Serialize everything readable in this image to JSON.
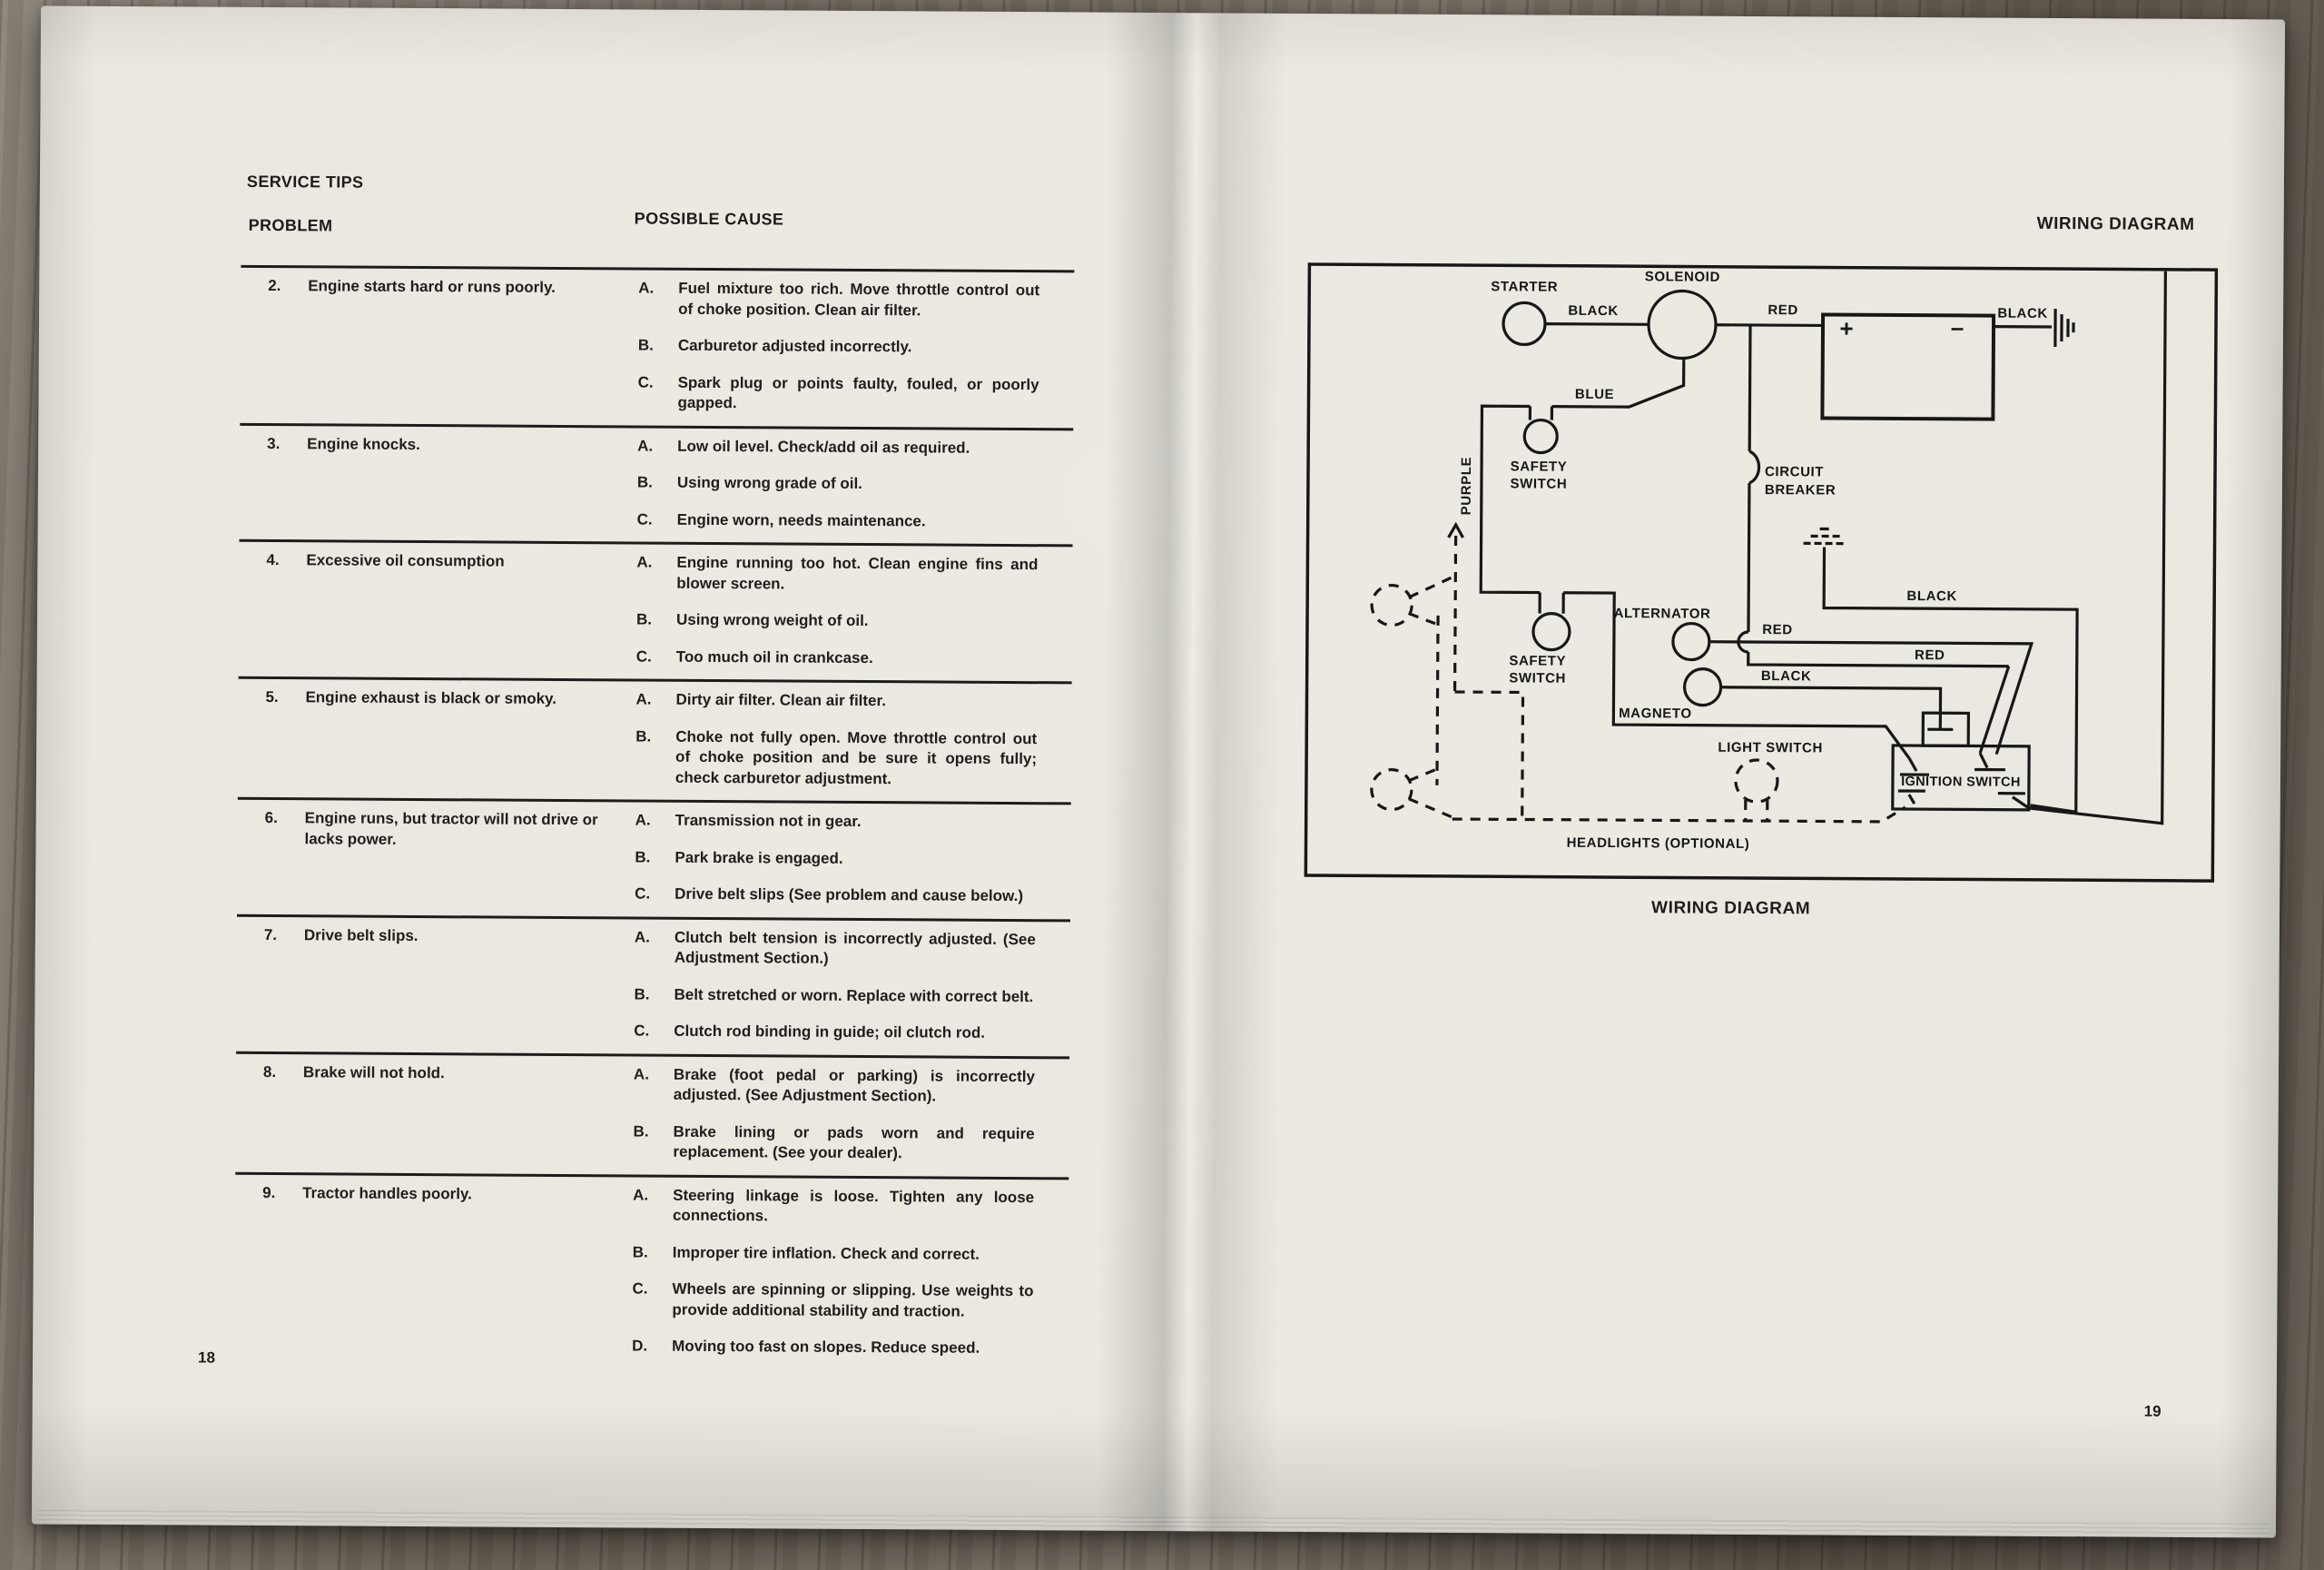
{
  "left_page": {
    "section_title": "SERVICE TIPS",
    "col_problem": "PROBLEM",
    "col_cause": "POSSIBLE CAUSE",
    "page_number": "18",
    "rows": [
      {
        "num": "2.",
        "problem": "Engine starts hard or runs poorly.",
        "causes": [
          {
            "letter": "A.",
            "text": "Fuel mixture too rich. Move throttle control out of choke position.  Clean air filter."
          },
          {
            "letter": "B.",
            "text": "Carburetor adjusted incorrectly."
          },
          {
            "letter": "C.",
            "text": "Spark plug or points faulty, fouled, or poorly gapped."
          }
        ]
      },
      {
        "num": "3.",
        "problem": "Engine knocks.",
        "causes": [
          {
            "letter": "A.",
            "text": "Low oil level.  Check/add oil as required."
          },
          {
            "letter": "B.",
            "text": "Using wrong grade of oil."
          },
          {
            "letter": "C.",
            "text": "Engine worn, needs maintenance."
          }
        ]
      },
      {
        "num": "4.",
        "problem": "Excessive oil consumption",
        "causes": [
          {
            "letter": "A.",
            "text": "Engine running too hot.  Clean engine fins and blower screen."
          },
          {
            "letter": "B.",
            "text": "Using wrong weight of oil."
          },
          {
            "letter": "C.",
            "text": "Too much oil in crankcase."
          }
        ]
      },
      {
        "num": "5.",
        "problem": "Engine exhaust is black or smoky.",
        "causes": [
          {
            "letter": "A.",
            "text": "Dirty air filter.  Clean air filter."
          },
          {
            "letter": "B.",
            "text": "Choke not fully open.  Move throttle control out of choke position and be sure it opens fully; check carburetor adjustment."
          }
        ]
      },
      {
        "num": "6.",
        "problem": "Engine runs, but tractor will not drive or lacks power.",
        "causes": [
          {
            "letter": "A.",
            "text": "Transmission not in gear."
          },
          {
            "letter": "B.",
            "text": "Park brake is engaged."
          },
          {
            "letter": "C.",
            "text": "Drive belt slips (See problem and cause below.)"
          }
        ]
      },
      {
        "num": "7.",
        "problem": "Drive belt slips.",
        "causes": [
          {
            "letter": "A.",
            "text": "Clutch belt tension is incorrectly adjusted.  (See Adjustment Section.)"
          },
          {
            "letter": "B.",
            "text": "Belt stretched or worn.  Replace with correct belt."
          },
          {
            "letter": "C.",
            "text": "Clutch rod binding in guide; oil clutch rod."
          }
        ]
      },
      {
        "num": "8.",
        "problem": "Brake will not hold.",
        "causes": [
          {
            "letter": "A.",
            "text": "Brake (foot pedal or parking) is incorrectly adjusted.  (See Adjustment Section)."
          },
          {
            "letter": "B.",
            "text": "Brake lining or pads worn and require replacement.  (See your dealer)."
          }
        ]
      },
      {
        "num": "9.",
        "problem": "Tractor handles poorly.",
        "causes": [
          {
            "letter": "A.",
            "text": "Steering linkage is loose.  Tighten any loose connections."
          },
          {
            "letter": "B.",
            "text": "Improper tire inflation.  Check and correct."
          },
          {
            "letter": "C.",
            "text": "Wheels are spinning or slipping.  Use weights to provide additional stability and traction."
          },
          {
            "letter": "D.",
            "text": "Moving too fast on slopes.  Reduce speed."
          }
        ]
      }
    ]
  },
  "right_page": {
    "header": "WIRING DIAGRAM",
    "caption": "WIRING DIAGRAM",
    "page_number": "19",
    "diagram": {
      "starter": "STARTER",
      "solenoid": "SOLENOID",
      "wire_black_starter": "BLACK",
      "wire_red_battery": "RED",
      "battery_plus": "+",
      "battery_minus": "–",
      "wire_black_battery_ground": "BLACK",
      "wire_blue": "BLUE",
      "wire_purple": "PURPLE",
      "safety_switch_top_line1": "SAFETY",
      "safety_switch_top_line2": "SWITCH",
      "safety_switch_bottom_line1": "SAFETY",
      "safety_switch_bottom_line2": "SWITCH",
      "circuit_breaker_line1": "CIRCUIT",
      "circuit_breaker_line2": "BREAKER",
      "alternator": "ALTERNATOR",
      "wire_red_alternator": "RED",
      "wire_black_alternator": "BLACK",
      "wire_red_breaker": "RED",
      "wire_black_ground": "BLACK",
      "magneto": "MAGNETO",
      "light_switch": "LIGHT SWITCH",
      "ignition_switch": "IGNITION SWITCH",
      "headlights": "HEADLIGHTS (OPTIONAL)"
    }
  }
}
